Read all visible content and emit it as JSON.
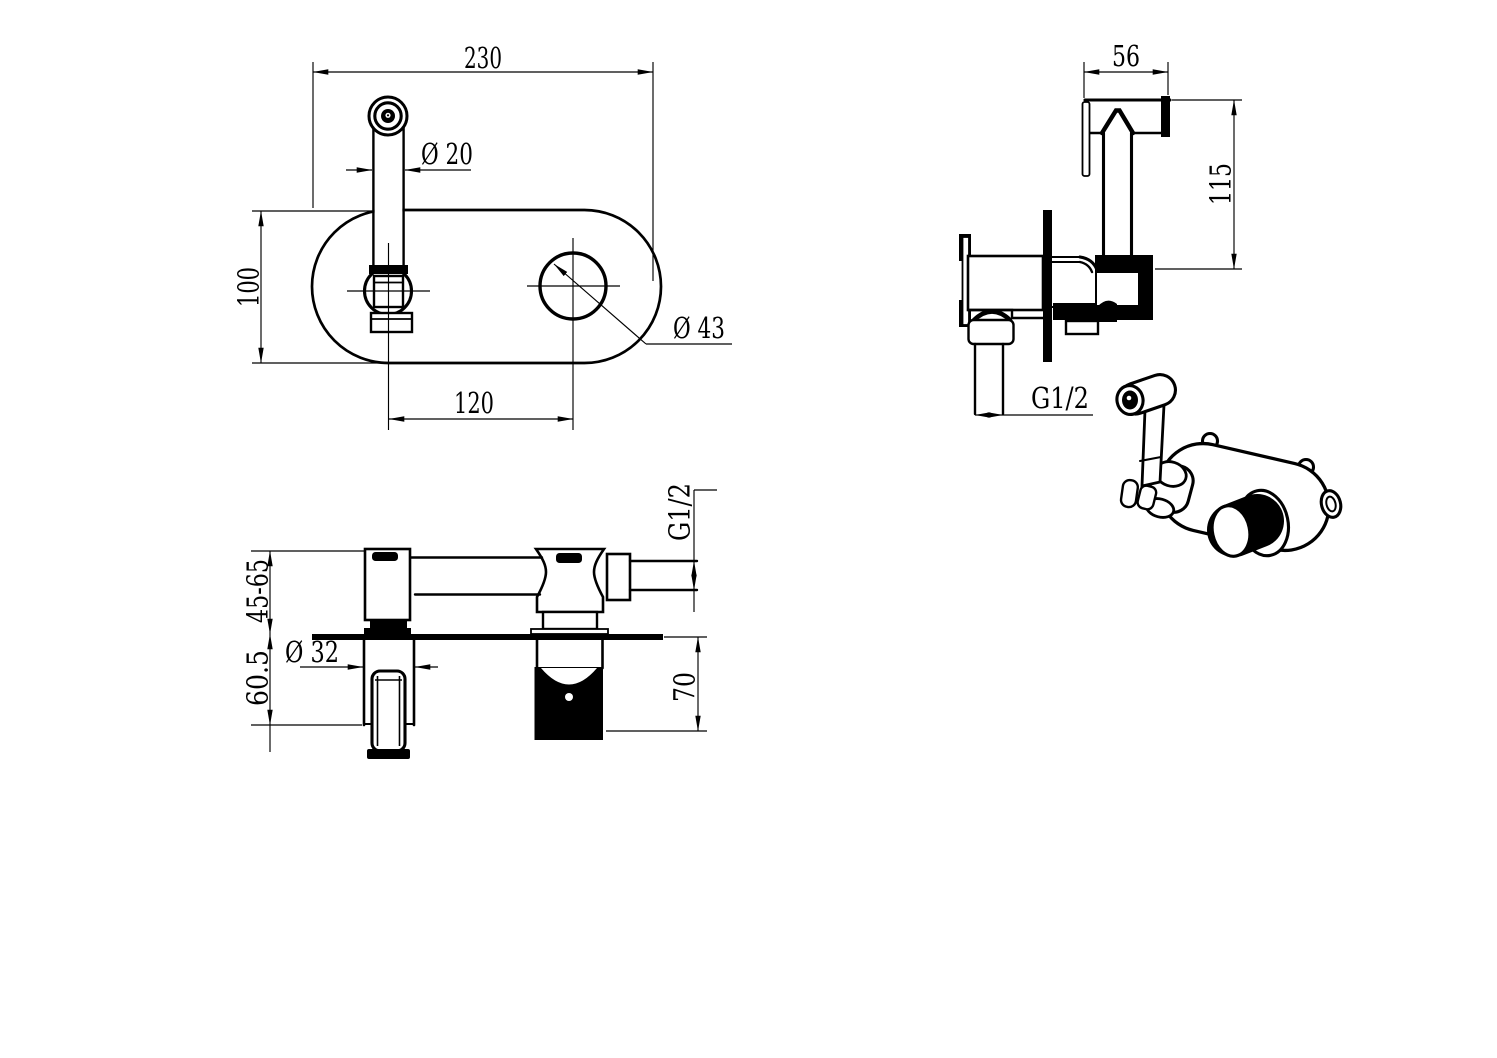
{
  "canvas": {
    "background": "#ffffff",
    "line_color": "#000000",
    "width": 1497,
    "height": 1058
  },
  "views": {
    "front": {
      "label": "front-view-wall-plate",
      "dims": {
        "plate_width": "230",
        "spout_diameter": "Ø 20",
        "plate_height": "100",
        "hole_spacing": "120",
        "knob_diameter": "Ø 43"
      }
    },
    "side": {
      "label": "side-view-sprayer-and-valve",
      "dims": {
        "head_width": "56",
        "head_height": "115",
        "inlet_thread": "G1/2"
      }
    },
    "section": {
      "label": "installation-section-view",
      "dims": {
        "wall_depth_range": "45-65",
        "recess_depth": "60.5",
        "sleeve_diameter": "Ø 32",
        "box_depth": "70",
        "outlet_thread": "G1/2"
      }
    },
    "isometric": {
      "label": "isometric-view"
    }
  }
}
